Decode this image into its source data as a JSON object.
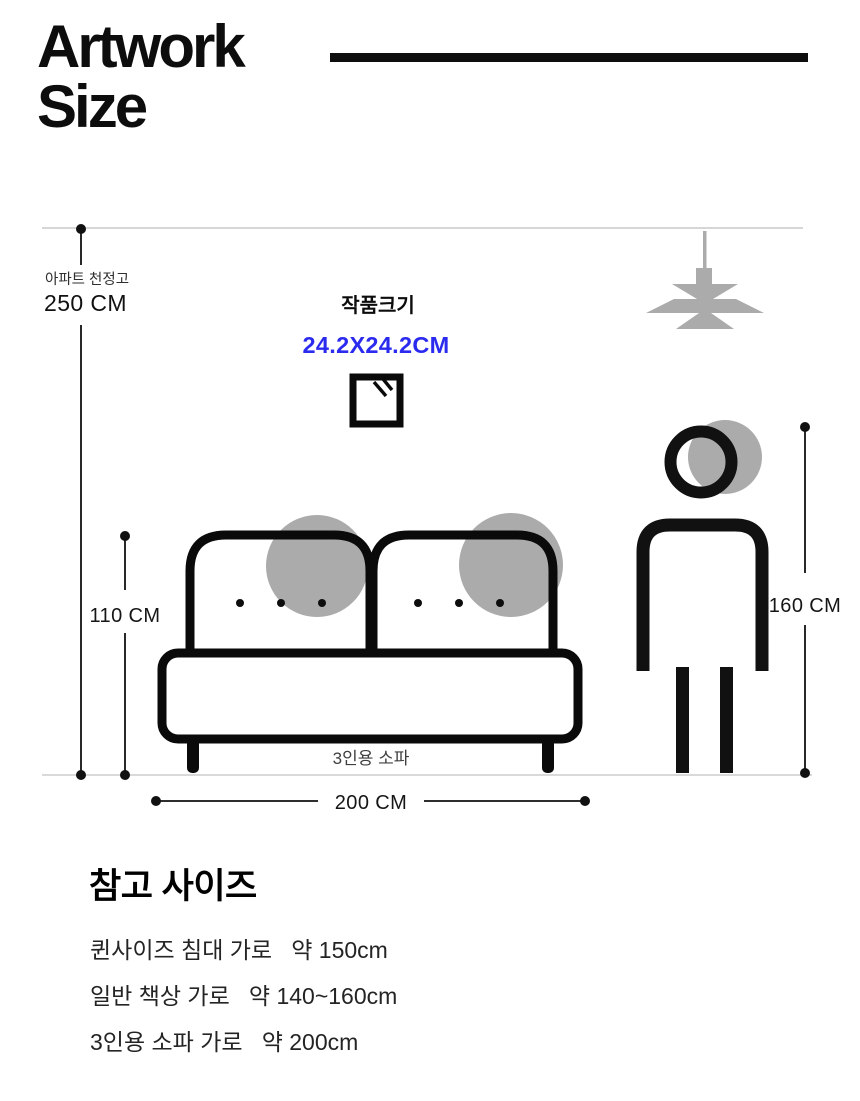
{
  "header": {
    "title_line1": "Artwork",
    "title_line2": "Size"
  },
  "diagram": {
    "ceiling_label": "아파트 천정고",
    "ceiling_height": "250 CM",
    "artwork_label": "작품크기",
    "artwork_size": "24.2X24.2CM",
    "artwork_accent_color": "#2b2bf0",
    "sofa_height": "110 CM",
    "sofa_width": "200 CM",
    "sofa_label": "3인용 소파",
    "person_height": "160 CM",
    "silhouette_gray": "#ababab",
    "line_gray": "#c2c2c2",
    "ink": "#0d0d0d"
  },
  "reference": {
    "heading": "참고 사이즈",
    "items": [
      "퀸사이즈 침대 가로   약 150cm",
      "일반 책상 가로   약 140~160cm",
      "3인용 소파 가로   약 200cm"
    ]
  }
}
